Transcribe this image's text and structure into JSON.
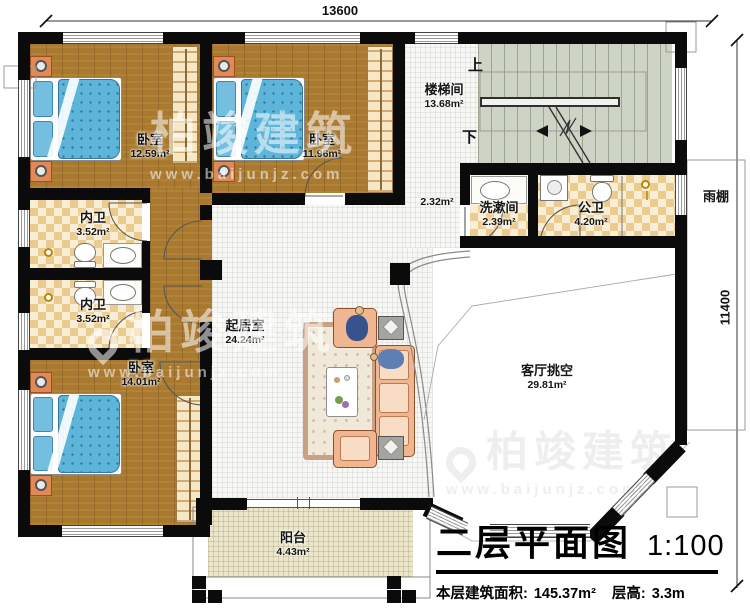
{
  "title_block": {
    "name": "二层平面图",
    "scale": "1:100",
    "area_label": "本层建筑面积:",
    "area_value": "145.37m²",
    "floor_height_label": "层高:",
    "floor_height_value": "3.3m"
  },
  "dimensions": {
    "width": "13600",
    "height": "11400"
  },
  "stair": {
    "up": "上",
    "down": "下"
  },
  "watermark": {
    "brand": "柏竣建筑",
    "site": "www.baijunjz.com"
  },
  "rooms": {
    "bedroom1": {
      "name": "卧室",
      "area": "12.59m²"
    },
    "bedroom2": {
      "name": "卧室",
      "area": "11.96m²"
    },
    "stairwell": {
      "name": "楼梯间",
      "area": "13.68m²"
    },
    "corridor": {
      "area": "2.32m²"
    },
    "ensuite1": {
      "name": "内卫",
      "area": "3.52m²"
    },
    "ensuite2": {
      "name": "内卫",
      "area": "3.52m²"
    },
    "washroom": {
      "name": "洗漱间",
      "area": "2.39m²"
    },
    "public_bath": {
      "name": "公卫",
      "area": "4.20m²"
    },
    "canopy": {
      "name": "雨棚"
    },
    "living": {
      "name": "起居室",
      "area": "24.24m²"
    },
    "bedroom3": {
      "name": "卧室",
      "area": "14.01m²"
    },
    "void": {
      "name": "客厅挑空",
      "area": "29.81m²"
    },
    "balcony": {
      "name": "阳台",
      "area": "4.43m²"
    }
  }
}
